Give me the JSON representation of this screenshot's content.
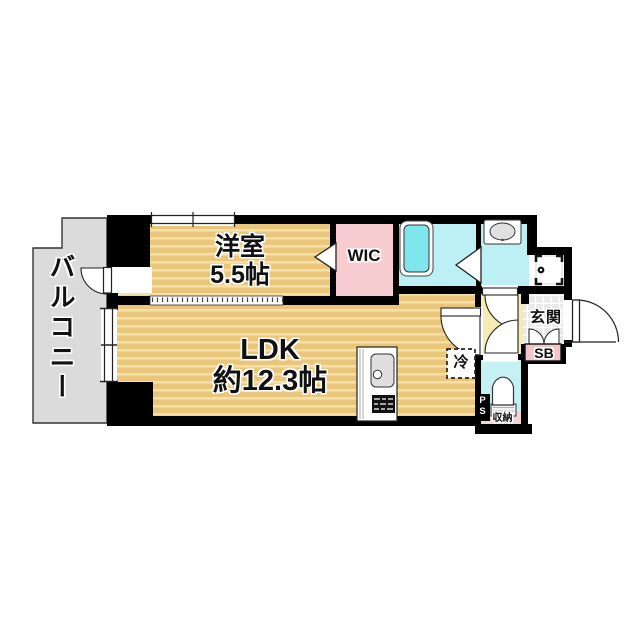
{
  "floorplan": {
    "rooms": {
      "balcony": {
        "label": "バルコニー"
      },
      "western_room": {
        "name": "洋室",
        "size": "5.5帖"
      },
      "ldk": {
        "name": "LDK",
        "size": "約12.3帖"
      },
      "wic": {
        "label": "WIC"
      },
      "entrance": {
        "label": "玄関"
      },
      "shoe_box": {
        "label": "SB"
      },
      "refrigerator": {
        "label": "冷"
      },
      "storage": {
        "label": "収納"
      },
      "pipe_space": {
        "p": "P",
        "s": "S"
      }
    },
    "colors": {
      "floor_tan": "#E9C67B",
      "floor_stripe": "#F5E1A8",
      "balcony_gray": "#DBDBDB",
      "wic_pink": "#F8CDD2",
      "wet_room_cyan": "#BCF0F4",
      "bathtub_cyan": "#7FE6ED",
      "hall_yellow": "#F4ECB2",
      "sb_pink": "#F2C6C8",
      "storage_pink": "#F3D5D5",
      "tile_gray": "#E9E9E9",
      "wall_black": "#000000"
    }
  }
}
